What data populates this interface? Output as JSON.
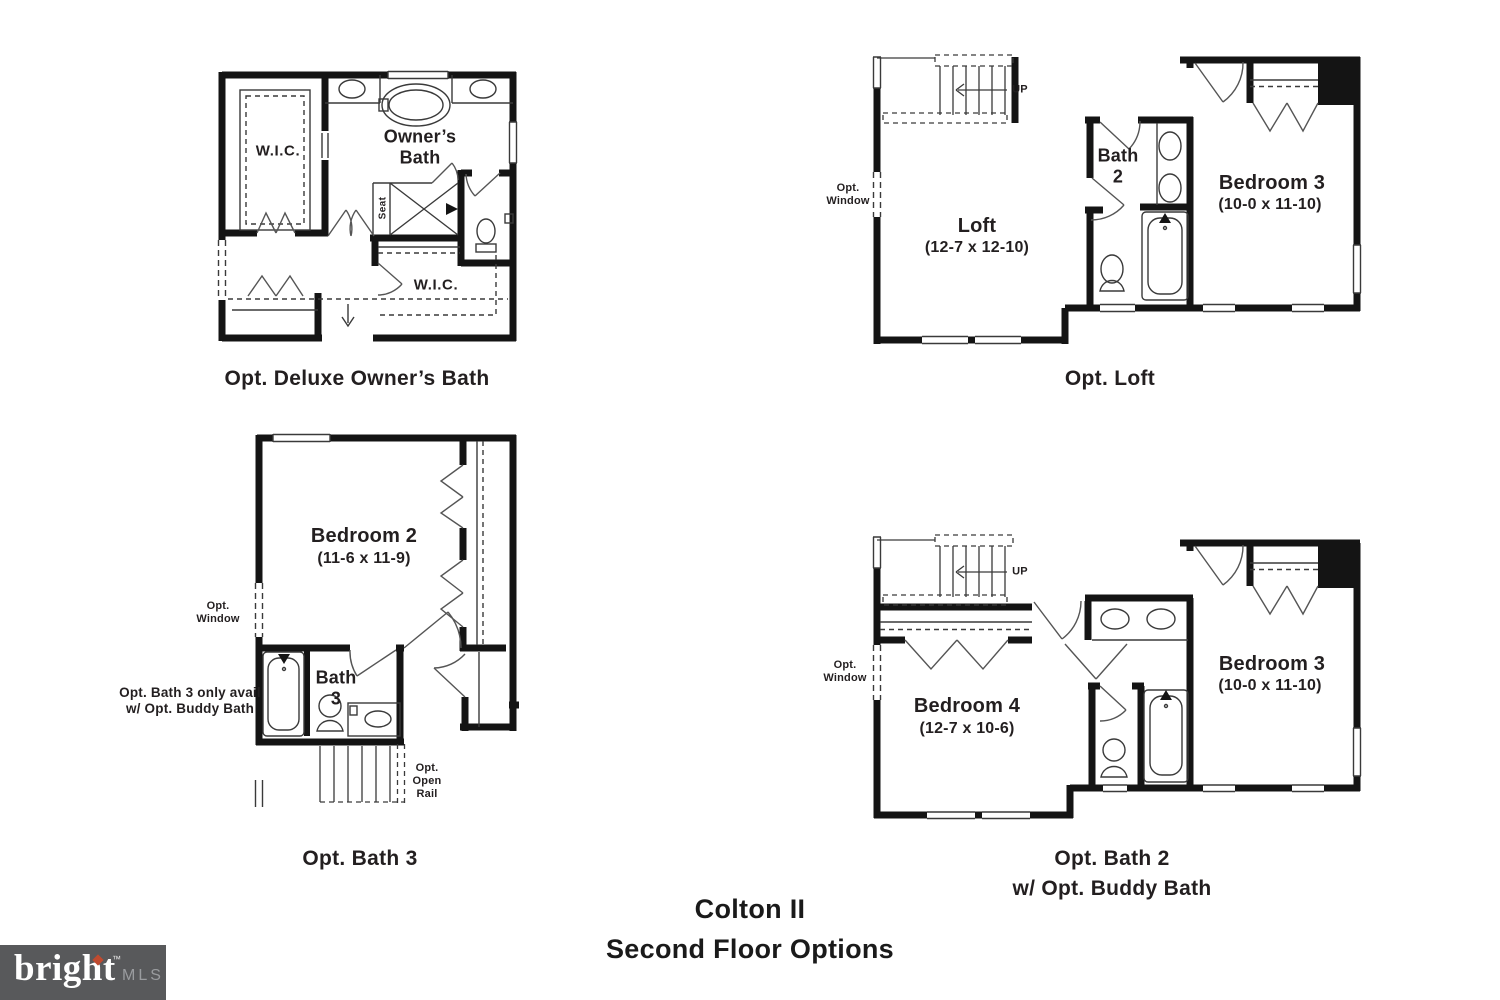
{
  "sheet": {
    "title": "Colton II\nSecond Floor Options"
  },
  "colors": {
    "wall": "#141414",
    "thin_line": "#3a3a3a",
    "text": "#231f20",
    "logo_background": "#58595b",
    "logo_brand_text": "#ffffff",
    "logo_diamond": "#bf4a2f",
    "logo_mls_text": "#9a9c9f"
  },
  "logo": {
    "brand": "bright",
    "tm": "™",
    "suffix": "MLS"
  },
  "plans": {
    "deluxe_owners_bath": {
      "caption": "Opt. Deluxe Owner’s Bath",
      "labels": {
        "wic_upper": "W.I.C.",
        "owners_bath": "Owner’s\nBath",
        "seat": "Seat",
        "wic_lower": "W.I.C."
      }
    },
    "loft": {
      "caption": "Opt. Loft",
      "labels": {
        "up": "UP",
        "opt_window": "Opt.\nWindow",
        "loft_name": "Loft",
        "loft_dims": "(12-7 x 12-10)",
        "bath2": "Bath\n2",
        "bedroom3_name": "Bedroom 3",
        "bedroom3_dims": "(10-0 x 11-10)"
      }
    },
    "bath3": {
      "caption": "Opt. Bath 3",
      "labels": {
        "bedroom2_name": "Bedroom 2",
        "bedroom2_dims": "(11-6 x 11-9)",
        "opt_window": "Opt.\nWindow",
        "bath3": "Bath\n3",
        "note": "Opt. Bath 3 only avail\nw/ Opt. Buddy Bath",
        "open_rail": "Opt.\nOpen\nRail"
      }
    },
    "buddy_bath": {
      "caption": "Opt. Bath 2\nw/ Opt. Buddy Bath",
      "labels": {
        "up": "UP",
        "opt_window": "Opt.\nWindow",
        "bedroom4_name": "Bedroom 4",
        "bedroom4_dims": "(12-7 x 10-6)",
        "bedroom3_name": "Bedroom 3",
        "bedroom3_dims": "(10-0 x 11-10)"
      }
    }
  }
}
